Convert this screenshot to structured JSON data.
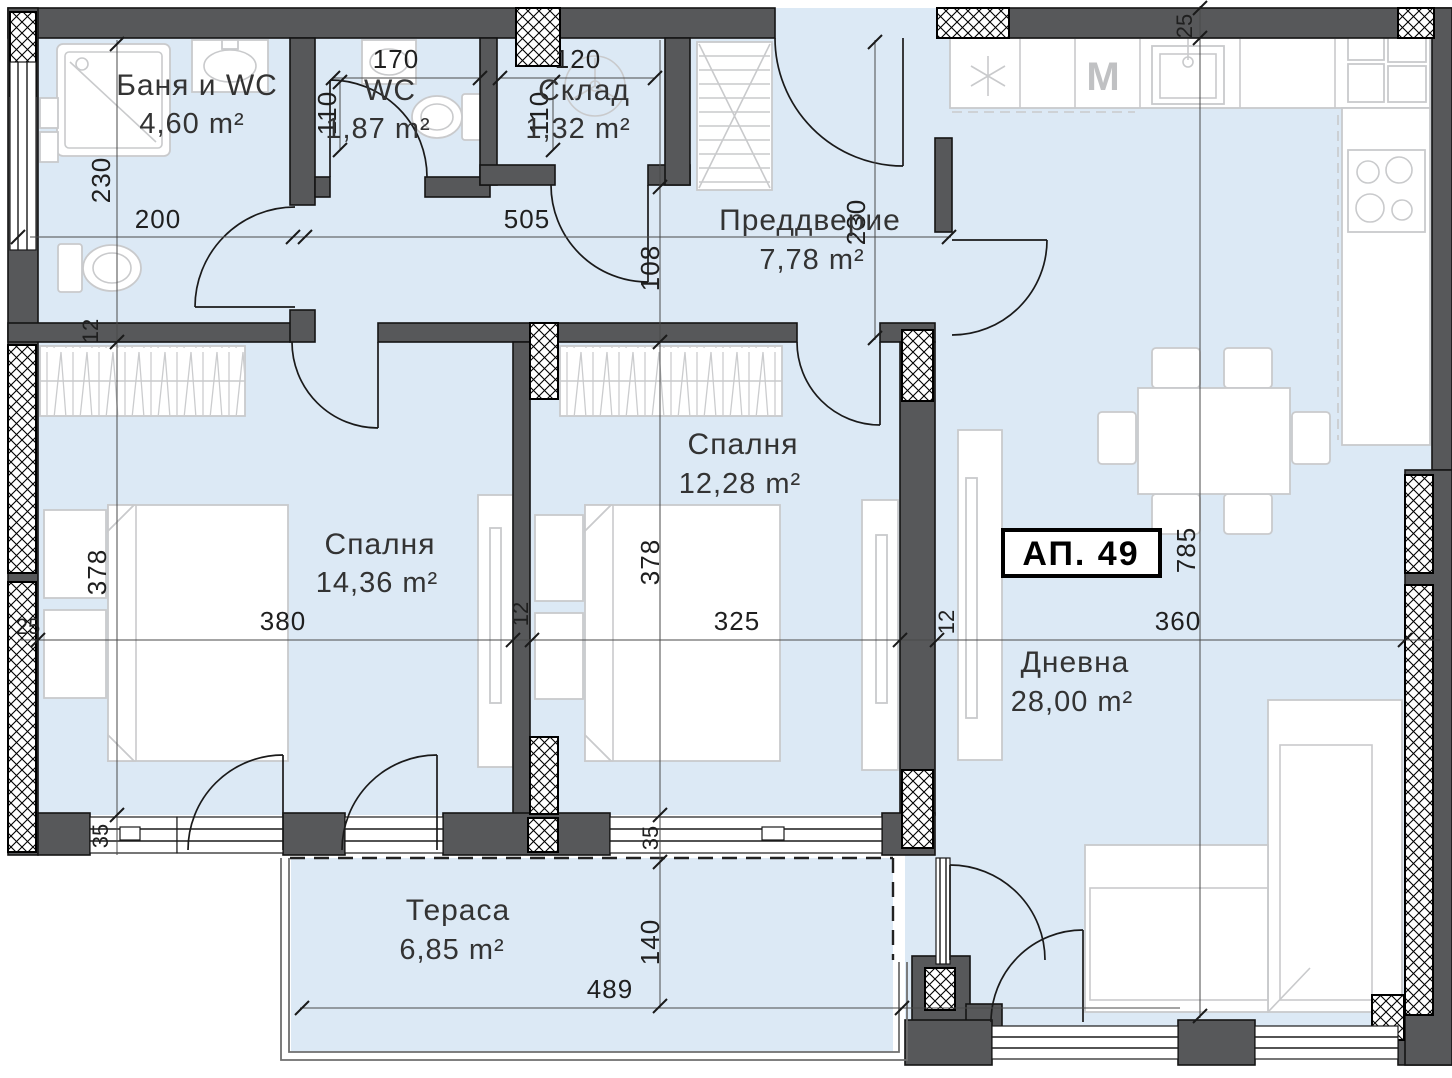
{
  "plan": {
    "apartment_label": "АП. 49",
    "rooms": [
      {
        "name": "Баня и WC",
        "area": "4,60 m²"
      },
      {
        "name": "WC",
        "area": "1,87 m²"
      },
      {
        "name": "Склад",
        "area": "1,32 m²"
      },
      {
        "name": "Преддверие",
        "area": "7,78 m²"
      },
      {
        "name": "Спалня",
        "area": "14,36 m²"
      },
      {
        "name": "Спалня",
        "area": "12,28 m²"
      },
      {
        "name": "Дневна",
        "area": "28,00 m²"
      },
      {
        "name": "Тераса",
        "area": "6,85 m²"
      }
    ],
    "dimensions": {
      "bath_height": "230",
      "bath_width": "200",
      "bath_wall": "12",
      "wc_width": "170",
      "wc_height": "110",
      "sklad_width": "120",
      "sklad_height": "110",
      "hall_width": "505",
      "hall_corridor": "108",
      "hall_height": "230",
      "top_wall": "25",
      "left_wall": "25",
      "bed1_height": "378",
      "bed1_width": "380",
      "mid_wall": "12",
      "bed2_height": "378",
      "bed2_width": "325",
      "right_wall": "12",
      "living_width": "360",
      "living_height": "785",
      "sill_left": "35",
      "sill_mid": "35",
      "terrace_depth": "140",
      "terrace_width": "489"
    },
    "appliances": {
      "washing_machine": "M"
    },
    "colors": {
      "floor": "#dce9f5",
      "wall": "#57585a",
      "furniture": "#c9cacc",
      "text": "#1f1f1f"
    }
  }
}
